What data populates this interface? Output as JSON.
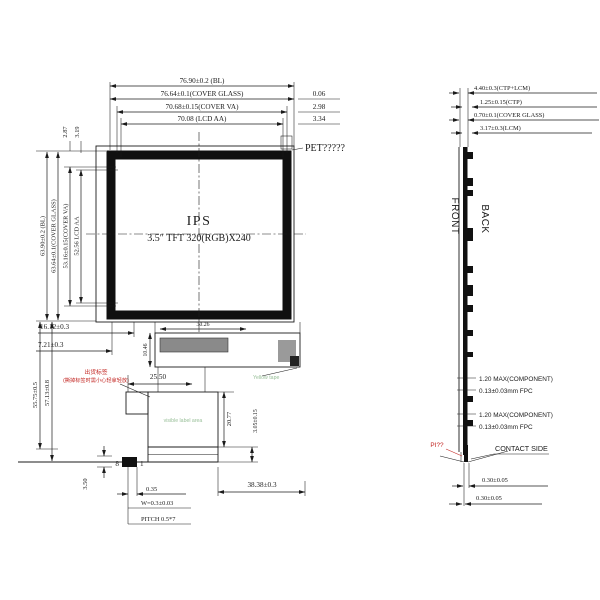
{
  "drawing": {
    "front": {
      "title_line1": "IPS",
      "title_line2": "3.5″ TFT 320(RGB)X240",
      "dim_top": [
        "76.90±0.2 (BL)",
        "76.64±0.1(COVER GLASS)",
        "70.68±0.15(COVER VA)",
        "70.08 (LCD AA)"
      ],
      "dim_top_right": [
        "0.06",
        "2.98",
        "3.34"
      ],
      "pet_label": "PET?????",
      "dim_left": [
        "63.90±0.2 (BL)",
        "63.64±0.1(COVER GLASS)",
        "53.16±0.15(COVER VA)",
        "52.56 LCD AA"
      ],
      "dim_left_top": [
        "2.87",
        "3.19"
      ],
      "dim_mid_left": [
        "16.12±0.3",
        "7.21±0.3"
      ],
      "note_red_line1": "出货标签",
      "note_red_line2": "(撕掉标签时需小心轻拿轻放)",
      "dim_left_bottom": [
        "55.75±0.5",
        "57.13±0.8"
      ],
      "dim_connector_width": "30.26",
      "dim_connector_height": "10.46",
      "dim_fpc_offset": "25.50",
      "note_tape": "Yellow tape",
      "note_label_area": "visible label area",
      "dim_label_height": "20.77",
      "dim_contact": "3.05±0.15",
      "dim_fpc_width": "38.38±0.3",
      "pin_first": "8",
      "pin_last": "1",
      "dim_pin_height": "3.50",
      "dim_pin": [
        "0.35",
        "W=0.3±0.03",
        "PITCH 0.5*7"
      ]
    },
    "side": {
      "front_label": "FRONT",
      "back_label": "BACK",
      "dim_top": [
        "4.40±0.3(CTP+LCM)",
        "1.25±0.15(CTP)",
        "0.70±0.1(COVER GLASS)",
        "3.17±0.3(LCM)"
      ],
      "dim_comp": [
        "1.20 MAX(COMPONENT)",
        "0.13±0.03mm FPC",
        "1.20 MAX(COMPONENT)",
        "0.13±0.03mm FPC"
      ],
      "contact_side": "CONTACT SIDE",
      "note_pi": "PI??",
      "dim_fpc": [
        "0.30±0.05",
        "0.30±0.05"
      ]
    },
    "colors": {
      "line": "#1b1b1b",
      "red": "#c22420",
      "green": "#98bf98"
    }
  }
}
